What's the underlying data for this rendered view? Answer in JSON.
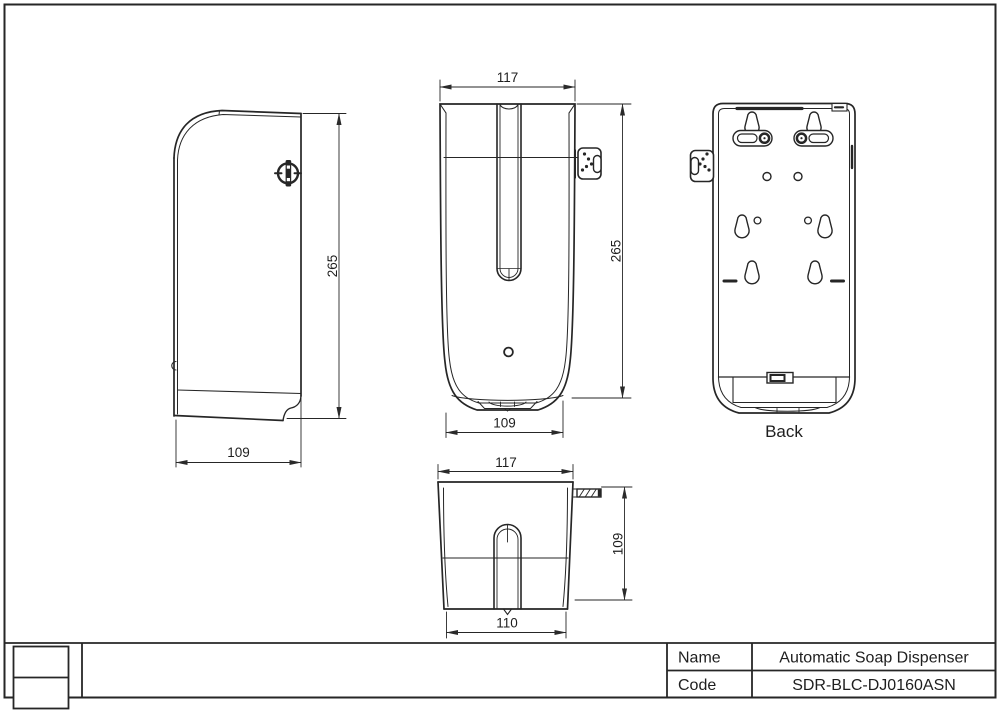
{
  "drawing": {
    "ink_color": "#262626",
    "views": {
      "side": {
        "height": "265",
        "width": "109"
      },
      "front": {
        "top_width": "117",
        "height": "265",
        "bottom_width": "109"
      },
      "back": {
        "caption": "Back"
      },
      "bottom": {
        "top_width": "117",
        "depth": "109",
        "bottom_width": "110"
      }
    },
    "title_block": {
      "name_label": "Name",
      "name_value": "Automatic Soap Dispenser",
      "code_label": "Code",
      "code_value": "SDR-BLC-DJ0160ASN"
    }
  }
}
